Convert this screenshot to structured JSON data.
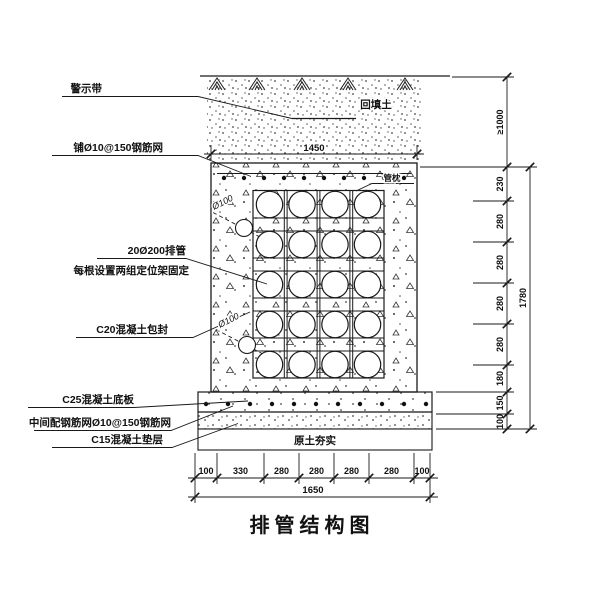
{
  "title": "排管结构图",
  "annotations": {
    "warning_tape": "警示带",
    "top_mesh": "铺Ø10@150钢筋网",
    "pipe_count": "20Ø200排管",
    "pipe_fixing": "每根设置两组定位架固定",
    "encasement": "C20混凝土包封",
    "base_slab": "C25混凝土底板",
    "mid_mesh": "中间配钢筋网Ø10@150钢筋网",
    "cushion": "C15混凝土垫层",
    "backfill": "回填土",
    "pipe_pillow": "管枕",
    "compacted_soil": "原土夯实",
    "small_pipe_dia_upper": "Ø100",
    "small_pipe_dia_lower": "Ø100"
  },
  "dimensions": {
    "top_width": "1450",
    "overall_bottom_width": "1650",
    "overall_height": "1780",
    "min_cover": "≥1000",
    "right_chain": [
      "230",
      "280",
      "280",
      "280",
      "280",
      "180",
      "150",
      "100"
    ],
    "bottom_chain": [
      "100",
      "330",
      "280",
      "280",
      "280",
      "280",
      "100"
    ]
  },
  "style": {
    "ink": "#1a1a1a",
    "paper": "#ffffff"
  }
}
